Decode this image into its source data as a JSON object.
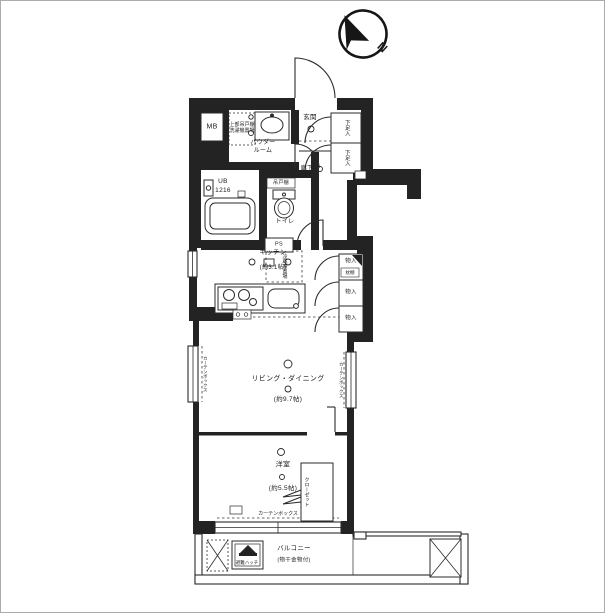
{
  "compass": {
    "north_label": "N"
  },
  "rooms": {
    "entrance": "玄関",
    "hallway": "廊下",
    "powder_room": "パウダー\nルーム",
    "unit_bath": "UB",
    "unit_bath_size": "1216",
    "toilet": "トイレ",
    "kitchen": "キッチン",
    "kitchen_area": "(約3.1帖)",
    "living_dining": "リビング・ダイニング",
    "living_dining_area": "(約9.7帖)",
    "bedroom": "洋室",
    "bedroom_area": "(約5.5帖)",
    "balcony": "バルコニー",
    "balcony_note": "(物干金物付)"
  },
  "storage": {
    "meter_box": "MB",
    "pipe_space": "PS",
    "shoe_cabinet_top": "下足入",
    "shoe_cabinet_bottom": "下足入",
    "storage_top": "物入",
    "storage_middle": "物入",
    "storage_bottom": "物入",
    "storage_shelf_note": "枕棚",
    "closet": "クローゼット",
    "toilet_cabinet": "吊戸棚",
    "refrigerator_space": "冷蔵庫置場",
    "laundry_space": "上部吊戸棚\n洗濯機置場",
    "escape_hatch": "避難ハッチ",
    "curtain_box_bottom": "カーテンボックス",
    "curtain_box_left": "カーテンボックス",
    "curtain_box_right": "カーテンボックス"
  },
  "colors": {
    "wall": "#232323",
    "line": "#2b2b2b",
    "background": "#ffffff",
    "frame": "#ababab"
  }
}
